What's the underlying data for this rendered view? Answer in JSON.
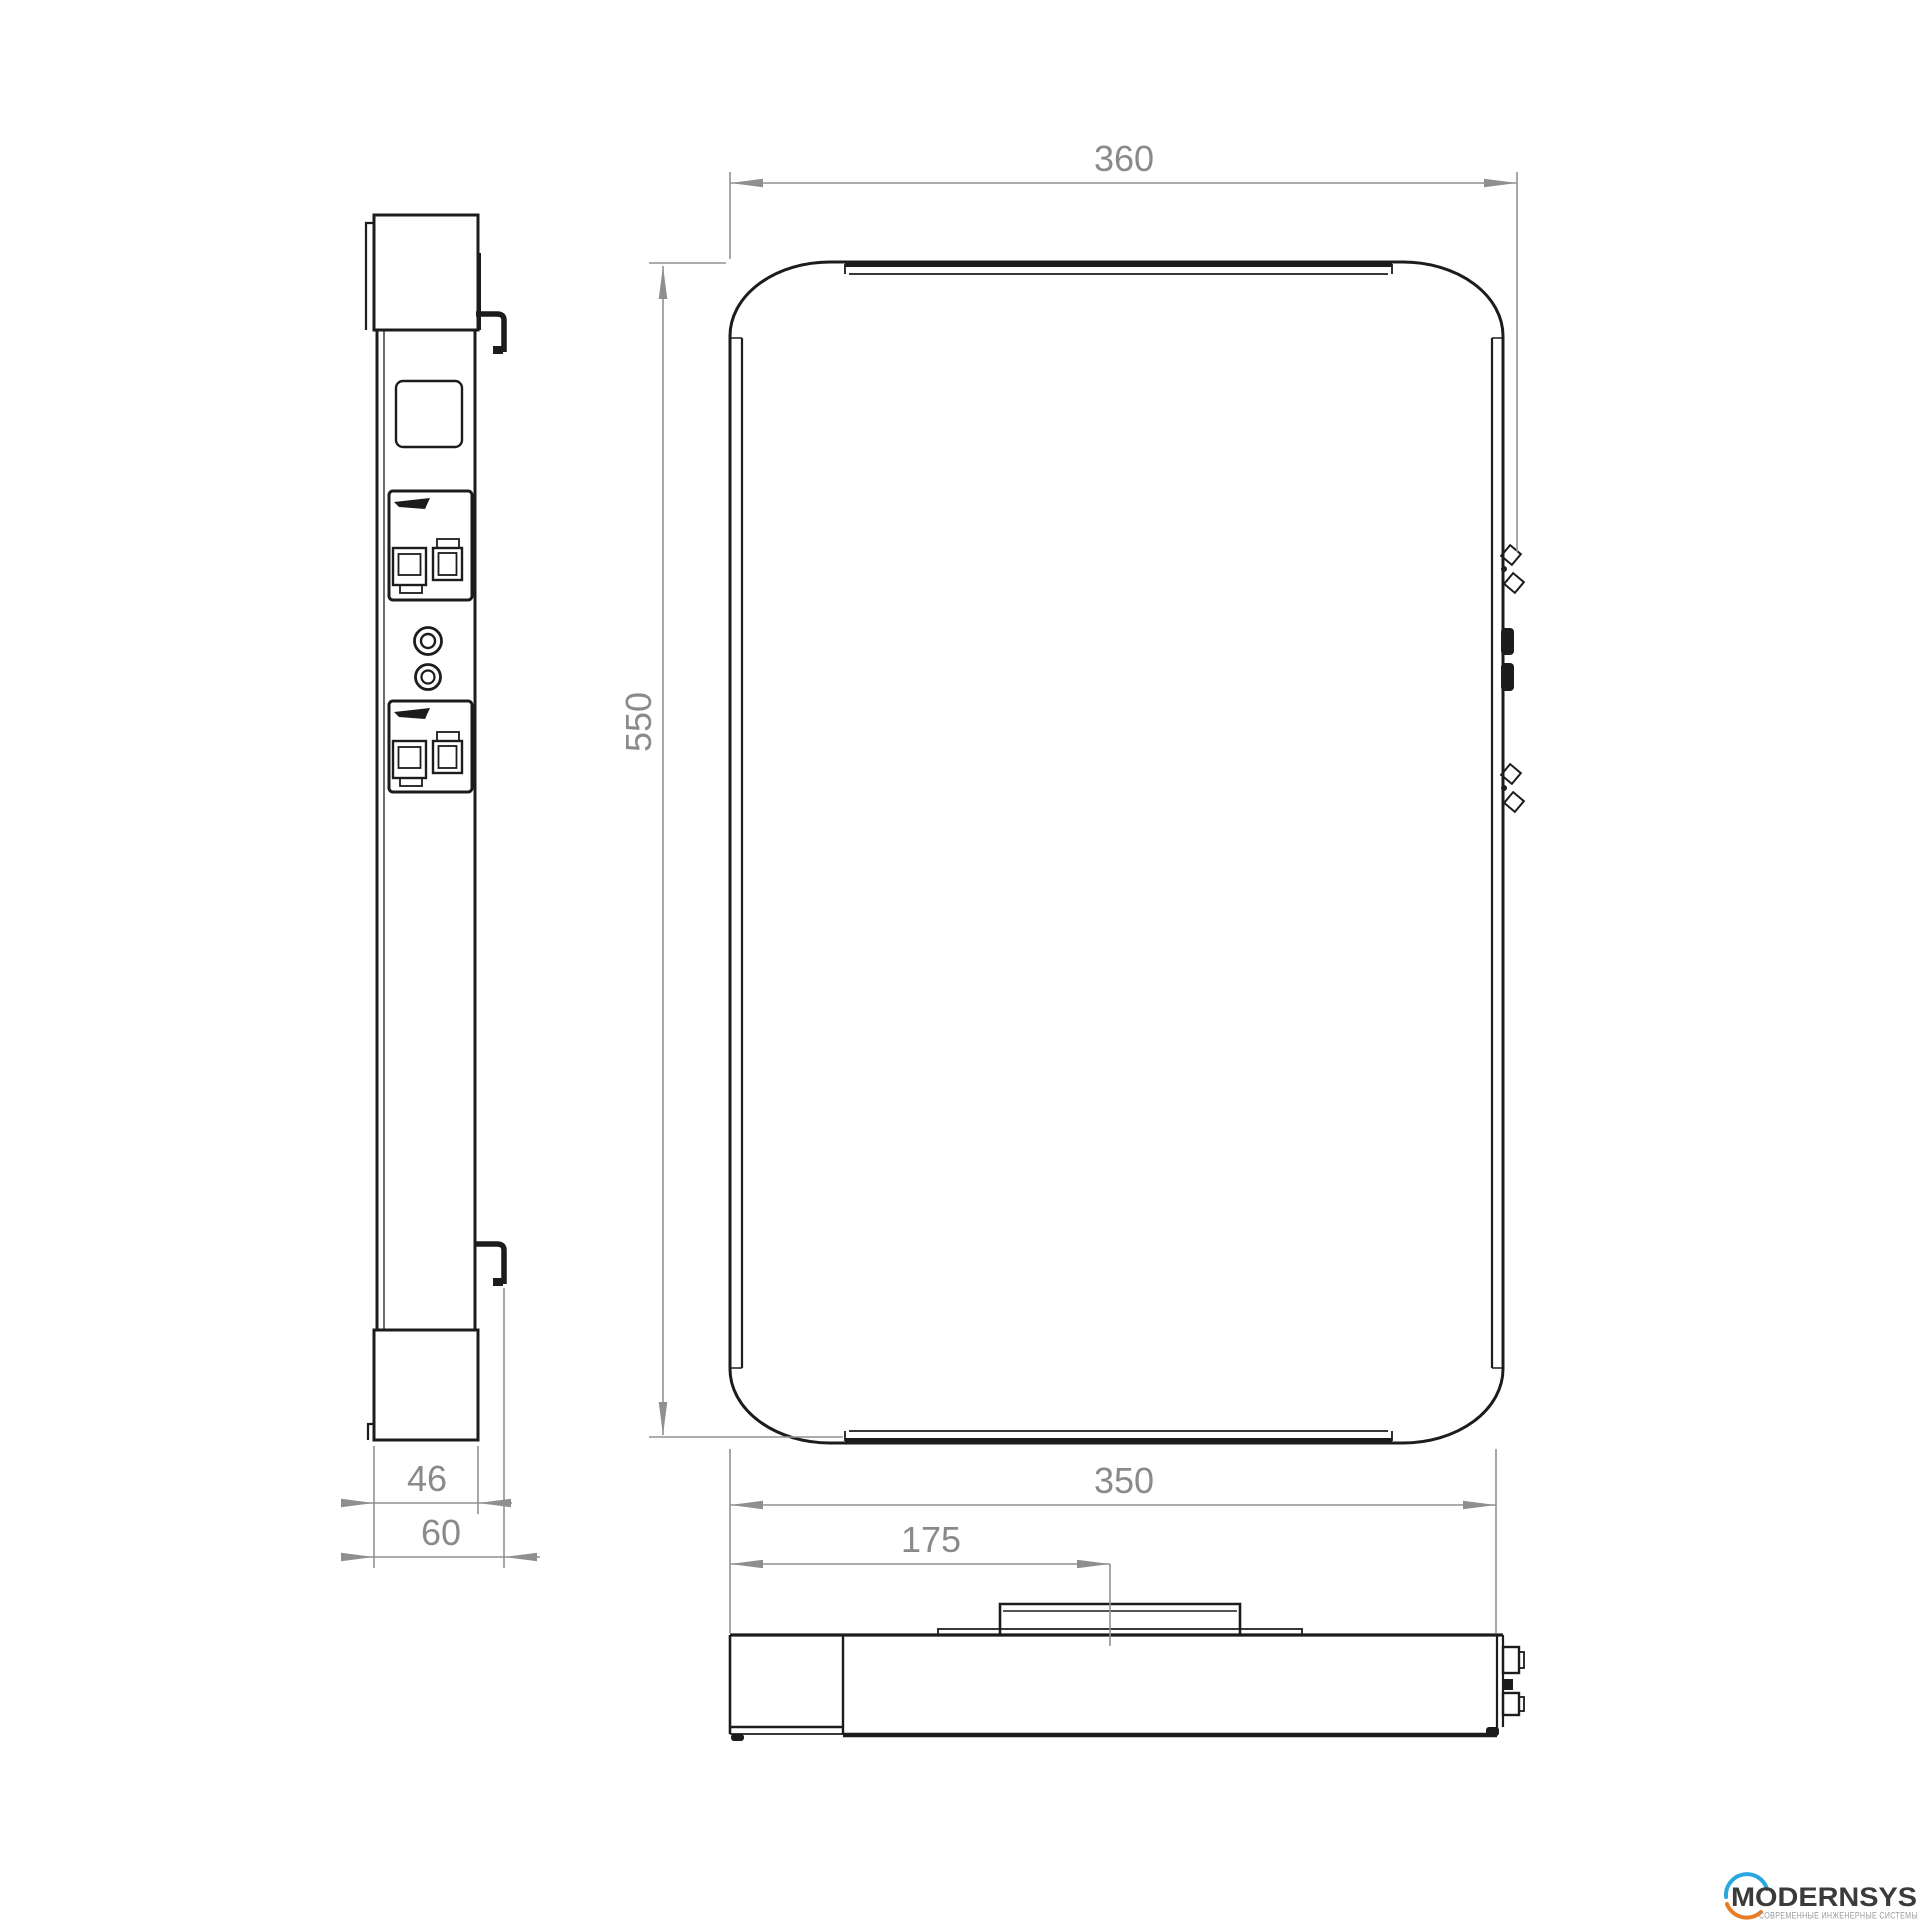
{
  "dimensions": {
    "front_width": "360",
    "front_height": "550",
    "body_width": "350",
    "mount_offset": "175",
    "body_depth": "46",
    "total_depth": "60"
  },
  "logo": {
    "wordmark": "MODERNSYS",
    "tagline": "СОВРЕМЕННЫЕ ИНЖЕНЕРНЫЕ СИСТЕМЫ",
    "arc_top_color": "#2aa7de",
    "arc_bottom_color": "#e87c26",
    "wordmark_color": "#3b3b3b",
    "tagline_color": "#9b9b9b"
  },
  "colors": {
    "background": "#ffffff",
    "object_line": "#1c1c1c",
    "dimension_line": "#919191",
    "dimension_text": "#8a8a8a"
  }
}
